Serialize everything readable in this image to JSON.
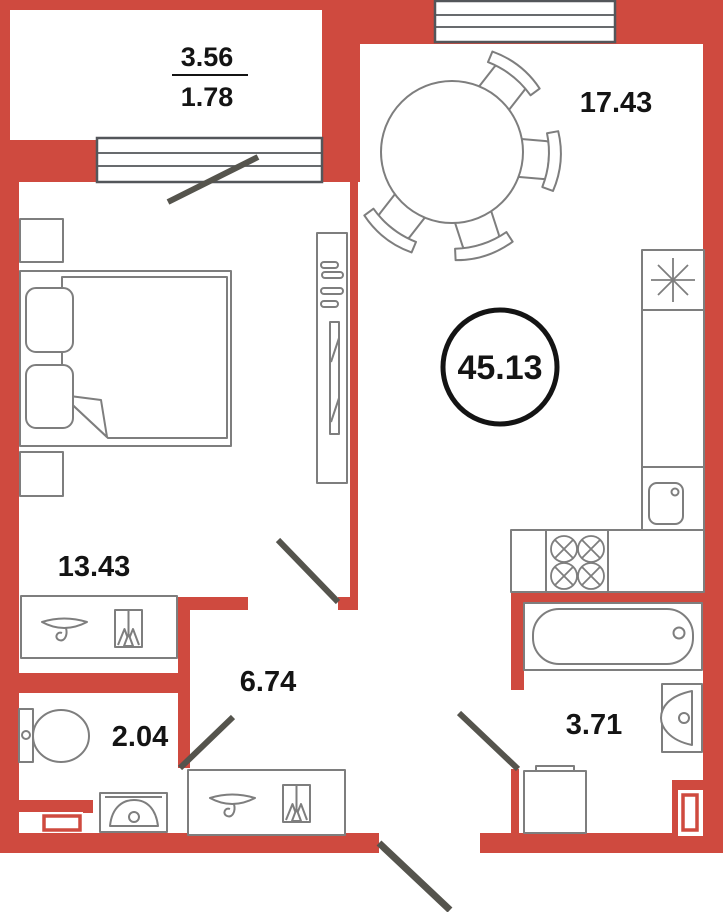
{
  "title": "Apartment floor plan",
  "total_area": "45.13",
  "rooms": {
    "balcony": {
      "name": "balcony",
      "area": "3.56",
      "reduced_area": "1.78"
    },
    "living_kitchen": {
      "name": "living-kitchen",
      "area": "17.43"
    },
    "bedroom": {
      "name": "bedroom",
      "area": "13.43"
    },
    "hallway": {
      "name": "hallway",
      "area": "6.74"
    },
    "toilet": {
      "name": "toilet",
      "area": "2.04"
    },
    "bathroom": {
      "name": "bathroom",
      "area": "3.71"
    }
  },
  "colors": {
    "wall": "#cf4a3f",
    "door_line": "#55544d",
    "window_frame": "#53565a",
    "furniture_line": "#7e7e7e",
    "label": "#141414"
  },
  "furniture_icons": [
    "double-bed",
    "pillow",
    "blanket",
    "nightstand",
    "wardrobe-shelves",
    "wardrobe-mirror",
    "round-dining-table",
    "chair",
    "refrigerator-snowflake",
    "kitchen-counter",
    "kitchen-sink",
    "stove-burners",
    "bathtub",
    "bathroom-washbasin",
    "washing-machine",
    "toilet",
    "toilet-washbasin",
    "hallway-cabinet-hook",
    "shoe-cabinet",
    "duct-shaft"
  ]
}
